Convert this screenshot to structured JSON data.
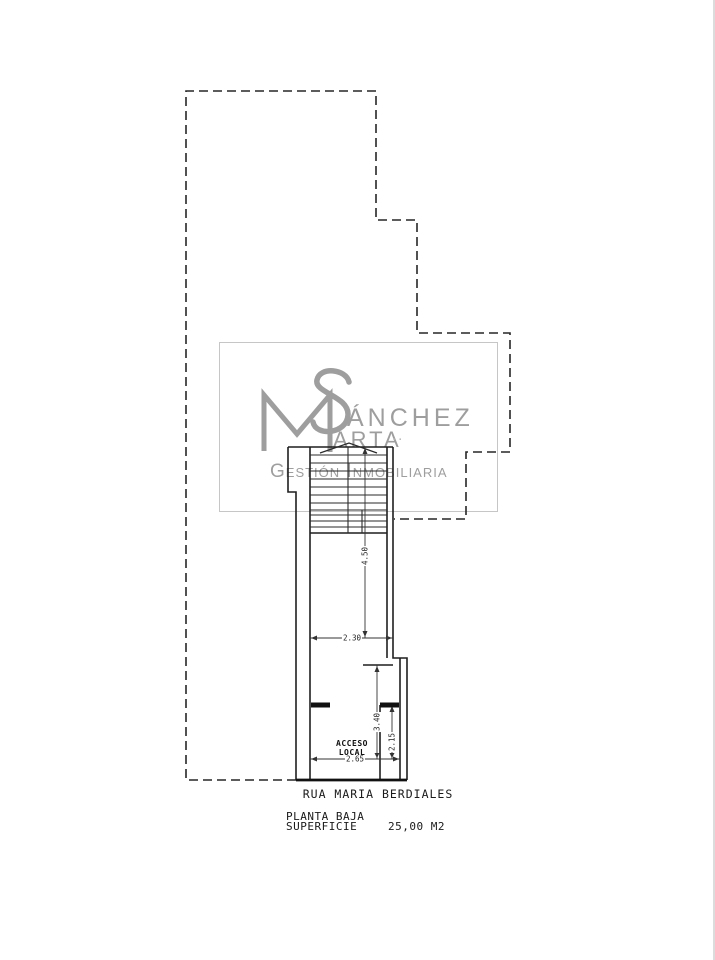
{
  "watermark": {
    "monogram": "MS",
    "surname_rest": "ÁNCHEZ",
    "firstname_rest": "ARTA",
    "dots": "..",
    "tagline": "Gestión Inmobiliaria"
  },
  "dimensions": {
    "stairs": "4.50",
    "corridor_width": "2.30",
    "access": "3.40",
    "entry": "2.15",
    "front": "2.65"
  },
  "labels": {
    "access_l1": "ACCESO",
    "access_l2": "LOCAL"
  },
  "street": "RUA MARIA BERDIALES",
  "title_block": {
    "title": "PLANTA BAJA",
    "surface_label": "SUPERFICIE",
    "surface_value": "25,00 M2"
  },
  "colors": {
    "line": "#1f1f1f",
    "dashed_boundary": "#262626",
    "dimension": "#333333",
    "watermark_gray": "#9e9e9e",
    "watermark_border": "#c6c6c6",
    "background": "#ffffff"
  }
}
